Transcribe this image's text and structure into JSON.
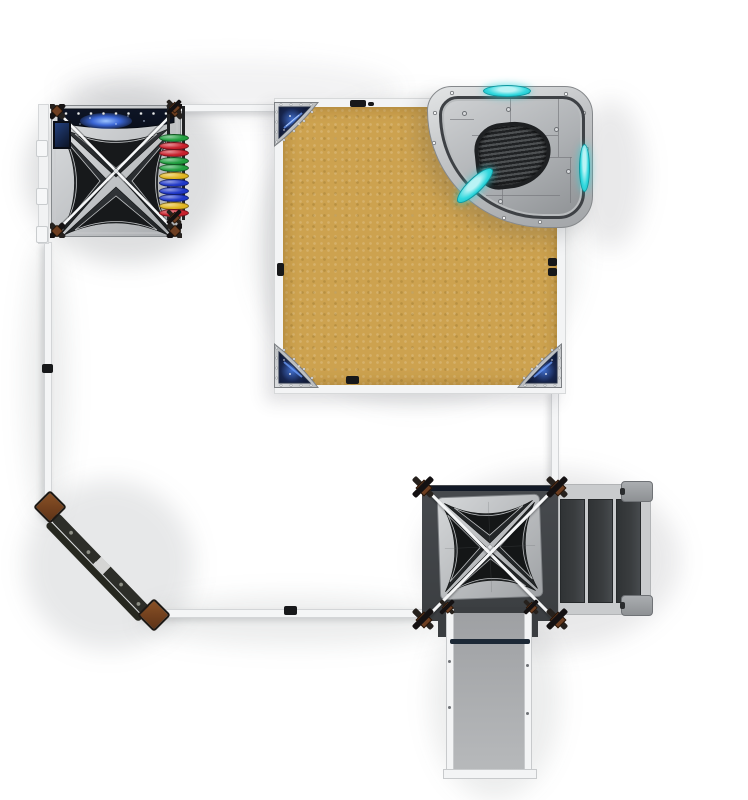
{
  "scene": {
    "title": "Space-themed playground set — top-down render",
    "view": "top-down plan view",
    "background_color": "#ffffff"
  },
  "theme": {
    "sand": "#cda24f",
    "silver_light": "#dcdee0",
    "silver_dark": "#a8abae",
    "roof_dark": "#26292b",
    "navy": "#0d1526",
    "nebula": "#4d7de0",
    "cyan": "#31d8de",
    "deck_dark": "#42454a",
    "stair_panel": "#3a3d3f",
    "ramp_gray": "#a9abae",
    "beam_white": "#f4f5f6",
    "beam_border": "#d3d5d7",
    "post_brown": "#7c4826",
    "beam_dark": "#2d2e29",
    "disc_red": "#c8202c",
    "disc_green": "#219e40",
    "disc_yellow": "#e0b520",
    "disc_blue": "#2038c8"
  },
  "components": {
    "tower_a": {
      "label": "Play tower A",
      "position": "top-left",
      "roof": "X-pyramid canopy",
      "galaxy_print_panels": 2,
      "rivet_count": 9
    },
    "disc_climber": {
      "label": "Rainbow disc climber",
      "disc_colors": [
        "#219e40",
        "#c8202c",
        "#c8202c",
        "#219e40",
        "#219e40",
        "#e0b520",
        "#2038c8",
        "#2038c8",
        "#2038c8",
        "#e0b520",
        "#c8202c"
      ]
    },
    "sand_deck": {
      "label": "Sand platform",
      "shape": "square",
      "color": "#cda24f",
      "edge_clamp_count": 5
    },
    "corner_shields": {
      "label": "Galaxy corner shields",
      "count": 3,
      "positions": [
        "top-left",
        "bottom-left",
        "bottom-right"
      ]
    },
    "spaceship_panel": {
      "label": "Curved spaceship roof panel",
      "position": "top-right",
      "cyan_lens_count": 3,
      "ribbed_hatch": true
    },
    "tower_b": {
      "label": "Play tower B",
      "position": "bottom-right",
      "roof": "X-pyramid canopy",
      "deck": "dark platform"
    },
    "stairs": {
      "label": "Step ladder",
      "panel_count": 3,
      "landing_caps": 2
    },
    "ramp": {
      "label": "Access ramp",
      "rails": 2,
      "crossbar": true
    },
    "balance_beam": {
      "label": "Balance beam",
      "position": "bottom-left diagonal",
      "posts": 2
    },
    "perimeter": {
      "label": "Border beams",
      "segments": [
        "top",
        "left",
        "diagonal",
        "bottom",
        "right"
      ],
      "corner_posts": 2
    }
  }
}
